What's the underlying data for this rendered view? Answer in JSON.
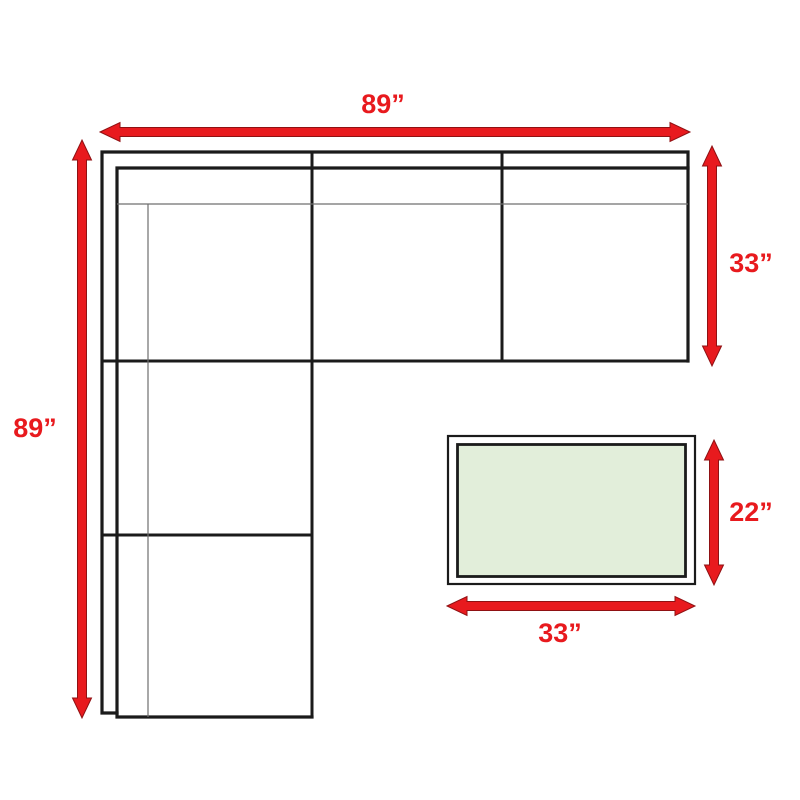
{
  "page": {
    "background": "#ffffff"
  },
  "colors": {
    "dimension_red": "#e81a1e",
    "dimension_red_edge": "#8f1113",
    "furniture_line": "#1b1b1b",
    "seam_line": "#6f6f6f",
    "table_top_fill": "#e2eeda",
    "table_frame_fill": "#ffffff"
  },
  "dimensions": {
    "sofa_width": "89”",
    "sofa_depth": "33”",
    "sofa_length": "89”",
    "table_depth": "22”",
    "table_width": "33”"
  }
}
